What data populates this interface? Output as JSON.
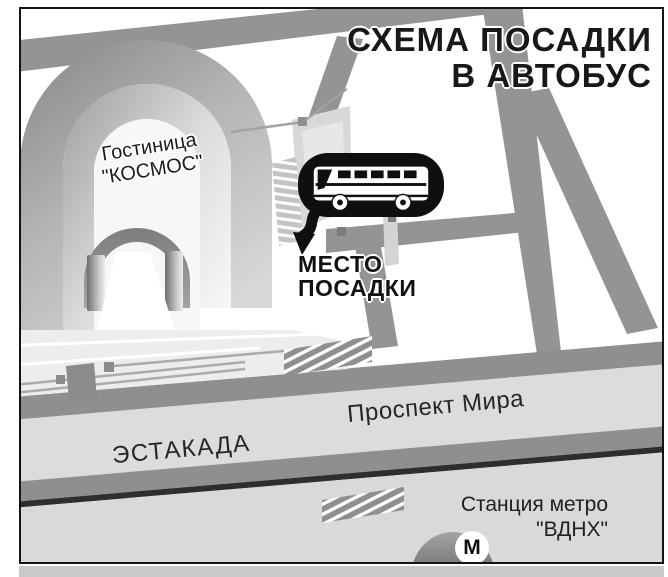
{
  "title": {
    "line1": "СХЕМА ПОСАДКИ",
    "line2": "В АВТОБУС"
  },
  "hotel": {
    "line1": "Гостиница",
    "line2": "\"КОСМОС\""
  },
  "boarding_point": {
    "line1": "МЕСТО",
    "line2": "ПОСАДКИ"
  },
  "roads": {
    "overpass": "ЭСТАКАДА",
    "avenue": "Проспект Мира"
  },
  "metro": {
    "line1": "Станция метро",
    "line2": "\"ВДНХ\"",
    "symbol": "М"
  },
  "icons": {
    "bus": "bus-side-view",
    "callout": "speech-bubble-with-arrow",
    "metro_logo": "M-in-circle"
  },
  "colors": {
    "road_gray": "#949494",
    "stripe_gray": "#8f8f8f",
    "band_light": "#dcdcdc",
    "dark_line": "#2e2e2e",
    "callout_black": "#0f0f0f",
    "text_black": "#181818",
    "frame_border": "#141414"
  }
}
